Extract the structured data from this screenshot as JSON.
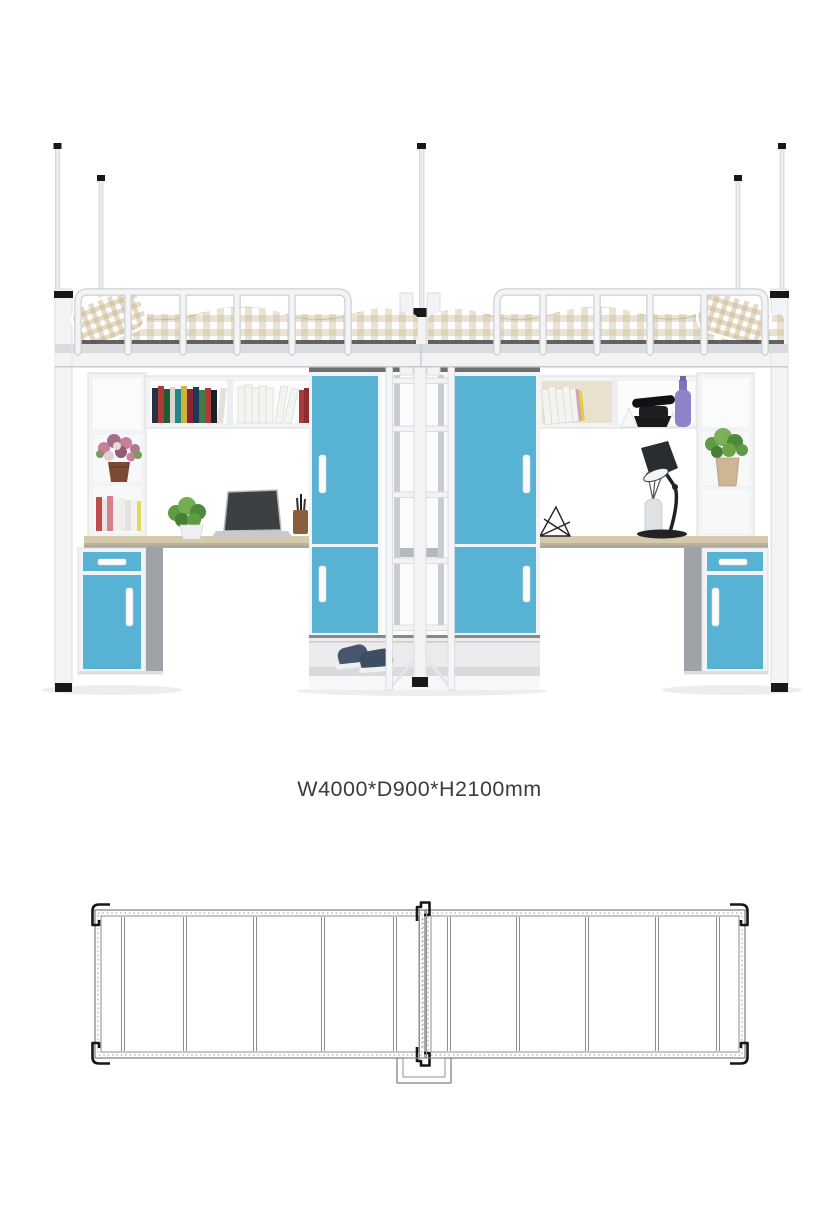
{
  "product": {
    "dimension_label": "W4000*D900*H2100mm"
  },
  "colors": {
    "background": "#ffffff",
    "text_color": "#3c3c3c",
    "accent_blue": "#58b2d3",
    "desk_wood": "#d6caad",
    "desk_wood_edge": "#bfb193",
    "frame_white": "#f2f3f5",
    "frame_outline": "#d9dcdf",
    "carcass_gray": "#9fa2a7",
    "bedding_beige": "#cdbb97",
    "shoe_navy": "#46566e",
    "bottle_purple": "#8d83c8",
    "plant_green": "#5d9b44",
    "plan_line": "#6f6f6f",
    "plan_bracket": "#161616"
  }
}
